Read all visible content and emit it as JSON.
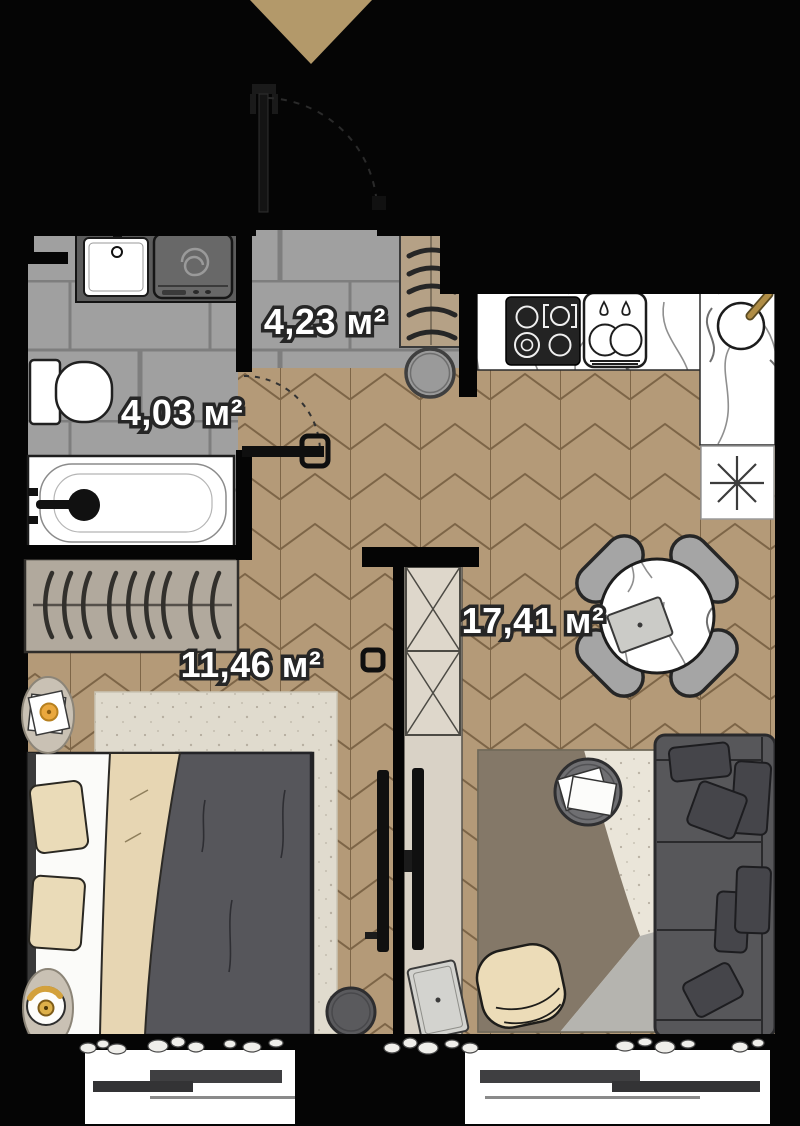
{
  "plan": {
    "title": "Studio apartment floor plan",
    "labels": {
      "hallway": "4,23 м²",
      "bathroom": "4,03 м²",
      "kitchen_living": "17,41 м²",
      "bedroom": "11,46 м²"
    },
    "colors": {
      "background": "#000000",
      "entrance_marker": "#b3996a",
      "parquet_base": "#b49a78",
      "parquet_line": "#7d6547",
      "tile_base": "#a0a0a0",
      "tile_grout": "#7e7e7e",
      "counter_marble": "#ffffff",
      "sofa": "#57575a",
      "duvet": "#56565b",
      "throw_blanket": "#e7d6b3",
      "rug_cream": "#eae5d9",
      "rug_brown": "#847868",
      "rug_gray": "#b5b4af",
      "accent_gold": "#d3a13c"
    },
    "furniture": [
      "entrance-door",
      "bathroom-sink",
      "washing-machine",
      "toilet",
      "bathtub",
      "hallway-cabinet",
      "stool",
      "stove",
      "kitchen-sink",
      "round-sink",
      "fridge-snowflake-symbol",
      "dining-table",
      "dining-chairs",
      "sofa",
      "coffee-table",
      "accent-chair",
      "tv-bedroom",
      "tv-living",
      "partition-wardrobe",
      "bed",
      "pillows",
      "nightstands",
      "table-lamp",
      "bedroom-closet",
      "bedroom-rug",
      "living-rug",
      "pouf",
      "windows",
      "pebbles"
    ]
  }
}
